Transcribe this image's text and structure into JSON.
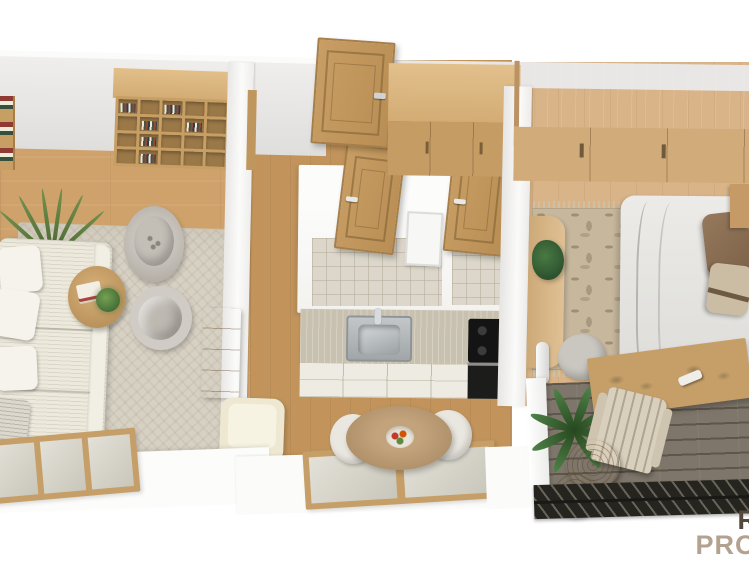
{
  "watermark": {
    "line1": "R",
    "line2": "PRO"
  },
  "palette": {
    "wood-floor": "#cfa26b",
    "wood-floor-dark": "#c2945c",
    "bedroom-floor": "#d9b488",
    "wood-furniture": "#c79e63",
    "wood-door": "#bf965e",
    "wardrobe-front": "#d2ab7a",
    "window-wood": "#c69f68",
    "rug-living": "#d7d1c4",
    "rug-bedroom": "#c6b79d",
    "sofa": "#edeadd",
    "pillow-white": "#f5f3eb",
    "pillow-beige": "#cbbda3",
    "counter-top": "#c9c1af",
    "cabinet-front": "#eeece2",
    "cooktop": "#141414",
    "tile": "#dcd7ca",
    "chair-white": "#e9e7df",
    "deck": "#7e766a",
    "railing": "#26241f",
    "adirondack": "#d9cfbd",
    "wm-dark": "#52483c",
    "wm-tan": "#b3a28f"
  },
  "scene": {
    "view": "top-down 3d apartment floor plan render",
    "rooms": [
      {
        "name": "living-room",
        "objects": [
          "bookshelf",
          "mini-shelf",
          "tall-plant",
          "striped-sofa",
          "white-pillows",
          "round-coffee-table",
          "books",
          "plant-on-table",
          "speckled-armchair",
          "swivel-armchair",
          "herringbone-rug",
          "wood-sideboard",
          "cream-lounge-chair",
          "window"
        ]
      },
      {
        "name": "hallway",
        "objects": [
          "open-entry-door",
          "wood-wardrobe"
        ]
      },
      {
        "name": "bathroom-wc",
        "objects": [
          "wood-door",
          "wood-door",
          "wall-cabinet",
          "tile-floor",
          "tile-floor"
        ]
      },
      {
        "name": "kitchen",
        "objects": [
          "countertop",
          "sink",
          "faucet",
          "black-cooktop",
          "black-oven",
          "cream-cabinet-drawers"
        ]
      },
      {
        "name": "dining-area",
        "objects": [
          "round-wood-table",
          "fruit-bowl",
          "white-chair",
          "white-chair",
          "window"
        ]
      },
      {
        "name": "bedroom",
        "objects": [
          "large-wardrobe",
          "double-bed",
          "brown-pillow",
          "beige-pillow",
          "floral-rug-with-fringe",
          "curved-desk",
          "desk-plant",
          "gray-chair",
          "floor-lamp",
          "nightstand"
        ]
      },
      {
        "name": "balcony",
        "objects": [
          "glass-slider-door",
          "palm-plant",
          "adirondack-chair",
          "rattan-side-table",
          "rattan-side-table",
          "dark-deck-floor",
          "slatted-railing"
        ]
      }
    ]
  }
}
